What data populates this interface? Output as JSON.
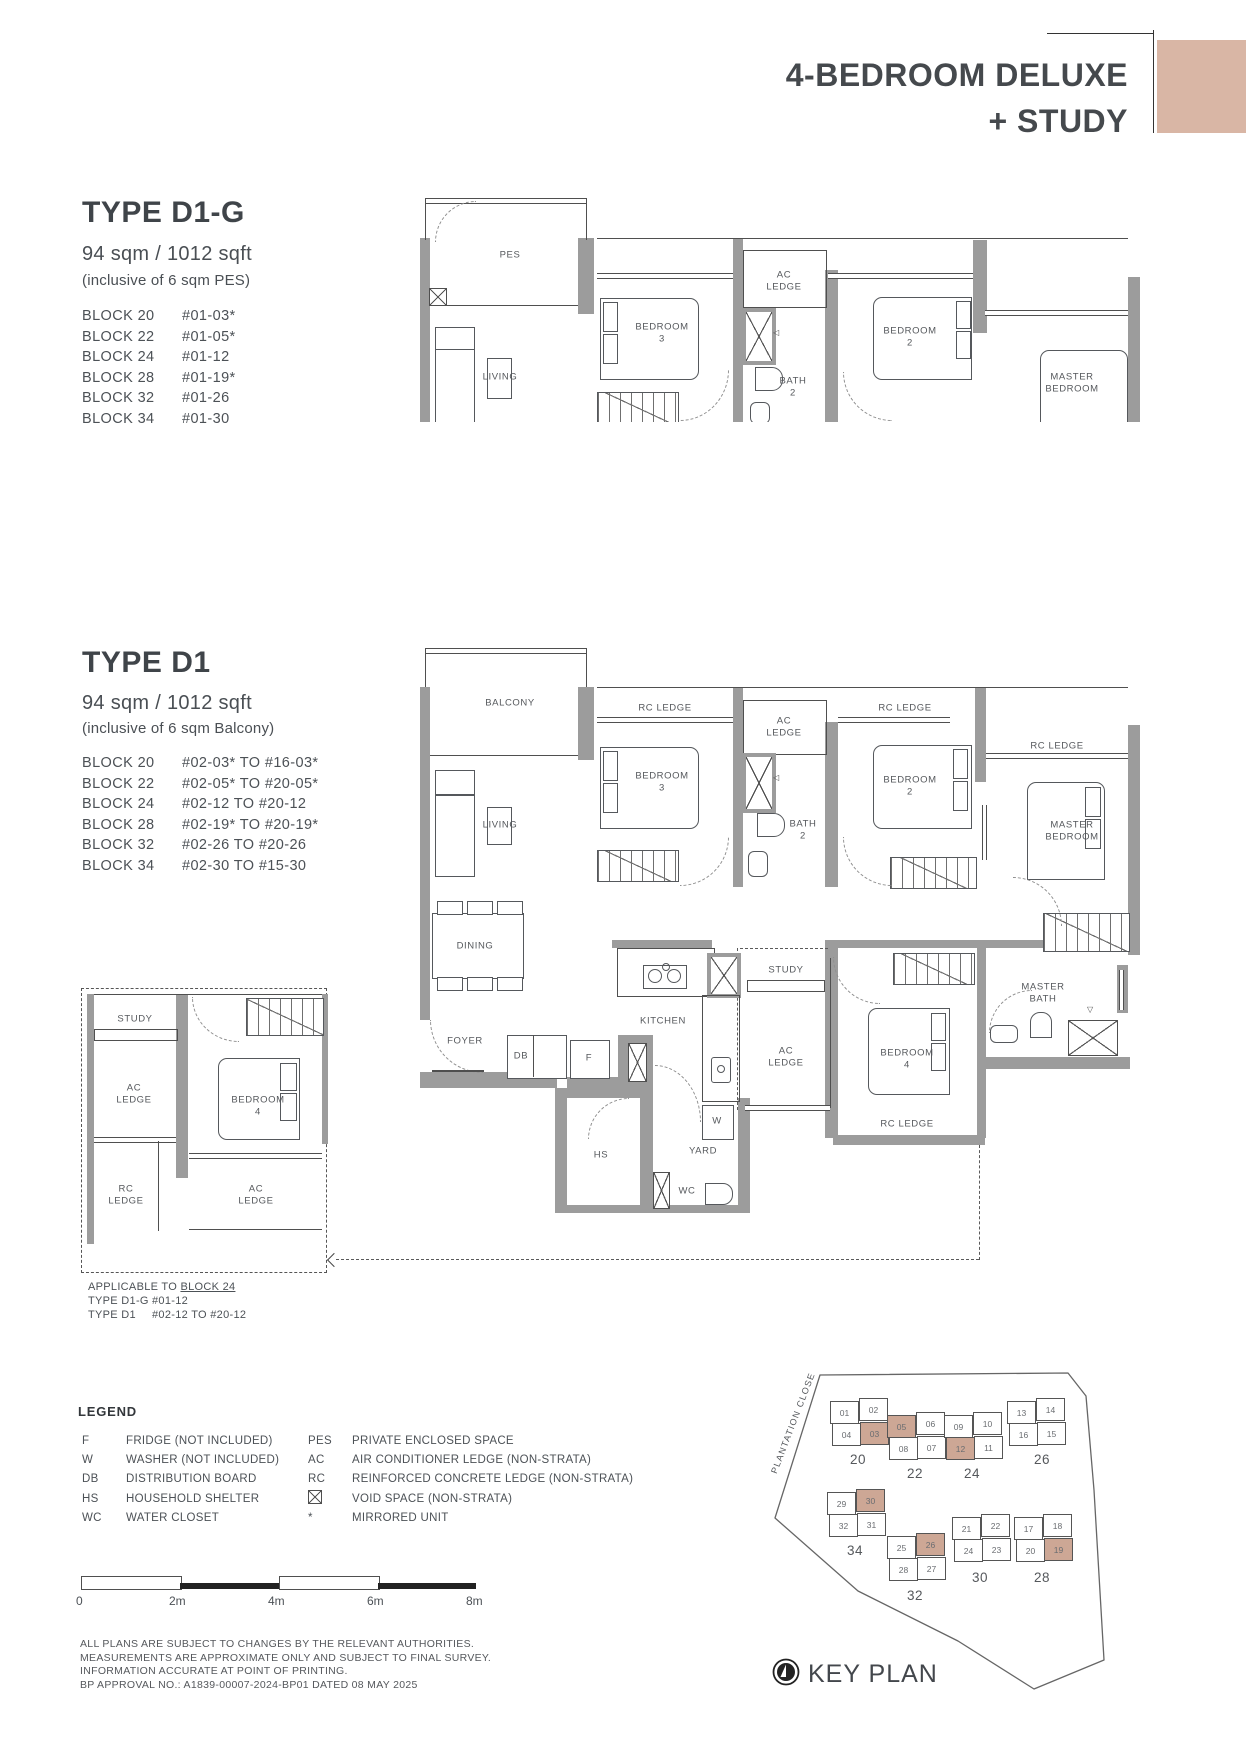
{
  "colors": {
    "accent": "#d9b6a5",
    "keyplan_highlight": "#cda795",
    "wall_gray": "#9c9c9c"
  },
  "header": {
    "title_line1": "4-BEDROOM DELUXE",
    "title_line2": "+ STUDY"
  },
  "type_d1g": {
    "name": "TYPE D1-G",
    "area": "94 sqm / 1012 sqft",
    "inclusive": "(inclusive of 6 sqm PES)",
    "blocks": [
      {
        "block": "BLOCK 20",
        "units": "#01-03*"
      },
      {
        "block": "BLOCK 22",
        "units": "#01-05*"
      },
      {
        "block": "BLOCK 24",
        "units": "#01-12"
      },
      {
        "block": "BLOCK 28",
        "units": "#01-19*"
      },
      {
        "block": "BLOCK 32",
        "units": "#01-26"
      },
      {
        "block": "BLOCK 34",
        "units": "#01-30"
      }
    ]
  },
  "type_d1": {
    "name": "TYPE D1",
    "area": "94 sqm / 1012 sqft",
    "inclusive": "(inclusive of 6 sqm Balcony)",
    "blocks": [
      {
        "block": "BLOCK 20",
        "units": "#02-03* TO #16-03*"
      },
      {
        "block": "BLOCK 22",
        "units": "#02-05* TO #20-05*"
      },
      {
        "block": "BLOCK 24",
        "units": "#02-12 TO #20-12"
      },
      {
        "block": "BLOCK 28",
        "units": "#02-19* TO #20-19*"
      },
      {
        "block": "BLOCK 32",
        "units": "#02-26 TO #20-26"
      },
      {
        "block": "BLOCK 34",
        "units": "#02-30 TO #15-30"
      }
    ]
  },
  "rooms": {
    "pes": "PES",
    "balcony": "BALCONY",
    "living": "LIVING",
    "dining": "DINING",
    "foyer": "FOYER",
    "kitchen": "KITCHEN",
    "study": "STUDY",
    "yard": "YARD",
    "bedroom2": "BEDROOM\n2",
    "bedroom3": "BEDROOM\n3",
    "bedroom4": "BEDROOM\n4",
    "master_bedroom": "MASTER\nBEDROOM",
    "master_bath": "MASTER\nBATH",
    "bath2": "BATH\n2",
    "ac_ledge": "AC\nLEDGE",
    "rc_ledge": "RC LEDGE",
    "rc_ledge_2line": "RC\nLEDGE",
    "hs": "HS",
    "db": "DB",
    "f": "F",
    "w": "W",
    "wc": "WC"
  },
  "inset": {
    "applicable": "APPLICABLE TO ",
    "applicable_block": "BLOCK 24",
    "rows": [
      {
        "type": "TYPE D1-G",
        "units": "#01-12"
      },
      {
        "type": "TYPE D1",
        "units": "#02-12 TO #20-12"
      }
    ]
  },
  "legend": {
    "title": "LEGEND",
    "left": [
      {
        "key": "F",
        "desc": "FRIDGE (NOT INCLUDED)"
      },
      {
        "key": "W",
        "desc": "WASHER (NOT INCLUDED)"
      },
      {
        "key": "DB",
        "desc": "DISTRIBUTION BOARD"
      },
      {
        "key": "HS",
        "desc": "HOUSEHOLD SHELTER"
      },
      {
        "key": "WC",
        "desc": "WATER CLOSET"
      }
    ],
    "right": [
      {
        "key": "PES",
        "desc": "PRIVATE ENCLOSED SPACE"
      },
      {
        "key": "AC",
        "desc": "AIR CONDITIONER LEDGE (NON-STRATA)"
      },
      {
        "key": "RC",
        "desc": "REINFORCED CONCRETE LEDGE (NON-STRATA)"
      },
      {
        "key": "",
        "icon": "void-space-icon",
        "desc": "VOID SPACE (NON-STRATA)"
      },
      {
        "key": "*",
        "desc": "MIRRORED UNIT"
      }
    ]
  },
  "scalebar": {
    "labels": [
      "0",
      "2m",
      "4m",
      "6m",
      "8m"
    ]
  },
  "disclaimer": [
    "ALL PLANS ARE SUBJECT TO CHANGES BY THE RELEVANT AUTHORITIES.",
    "MEASUREMENTS ARE APPROXIMATE ONLY AND SUBJECT TO FINAL SURVEY.",
    "INFORMATION ACCURATE AT POINT OF PRINTING.",
    "BP APPROVAL NO.: A1839-00007-2024-BP01 DATED 08 MAY 2025"
  ],
  "keyplan": {
    "road": "PLANTATION CLOSE",
    "label": "KEY PLAN",
    "blocks": [
      {
        "name": "20",
        "units": [
          "01",
          "02",
          "04",
          "03"
        ],
        "highlighted": [
          "03"
        ]
      },
      {
        "name": "22",
        "units": [
          "05",
          "06",
          "08",
          "07"
        ],
        "highlighted": [
          "05"
        ]
      },
      {
        "name": "24",
        "units": [
          "09",
          "10",
          "12",
          "11"
        ],
        "highlighted": [
          "12"
        ]
      },
      {
        "name": "26",
        "units": [
          "13",
          "14",
          "16",
          "15"
        ],
        "highlighted": []
      },
      {
        "name": "34",
        "units": [
          "29",
          "30",
          "32",
          "31"
        ],
        "highlighted": [
          "30"
        ]
      },
      {
        "name": "32",
        "units": [
          "25",
          "26",
          "28",
          "27"
        ],
        "highlighted": [
          "26"
        ]
      },
      {
        "name": "30",
        "units": [
          "21",
          "22",
          "24",
          "23"
        ],
        "highlighted": []
      },
      {
        "name": "28",
        "units": [
          "17",
          "18",
          "20",
          "19"
        ],
        "highlighted": [
          "19"
        ]
      }
    ]
  }
}
